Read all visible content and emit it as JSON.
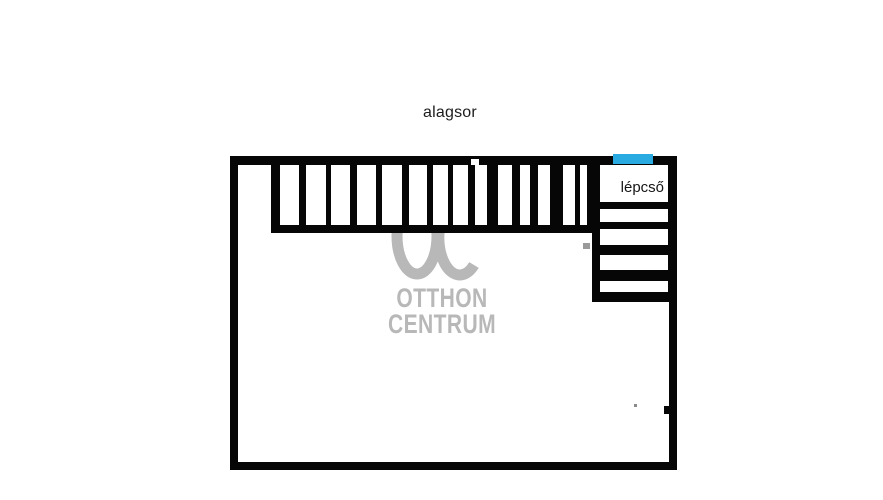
{
  "title": "alagsor",
  "floor_plan": {
    "room_label": "lépcső",
    "colors": {
      "wall": "#060606",
      "accent_blue": "#29ABE2",
      "watermark_gray": "#b8b8b8",
      "background": "#ffffff"
    },
    "storage_cells": [
      {
        "x": 280,
        "w": 19
      },
      {
        "x": 306,
        "w": 20
      },
      {
        "x": 331,
        "w": 19
      },
      {
        "x": 357,
        "w": 19
      },
      {
        "x": 382,
        "w": 20
      },
      {
        "x": 409,
        "w": 18
      },
      {
        "x": 433,
        "w": 15
      },
      {
        "x": 453,
        "w": 15
      },
      {
        "x": 475,
        "w": 12
      },
      {
        "x": 498,
        "w": 14
      },
      {
        "x": 520,
        "w": 10
      },
      {
        "x": 538,
        "w": 12
      },
      {
        "x": 563,
        "w": 12
      },
      {
        "x": 580,
        "w": 7
      }
    ],
    "staircase_steps": [
      {
        "y": 165,
        "h": 37
      },
      {
        "y": 209,
        "h": 13
      },
      {
        "y": 229,
        "h": 16
      },
      {
        "y": 255,
        "h": 15
      },
      {
        "y": 281,
        "h": 11
      }
    ]
  },
  "watermark": {
    "letters": "OC",
    "line1": "OTTHON",
    "line2": "CENTRUM"
  }
}
